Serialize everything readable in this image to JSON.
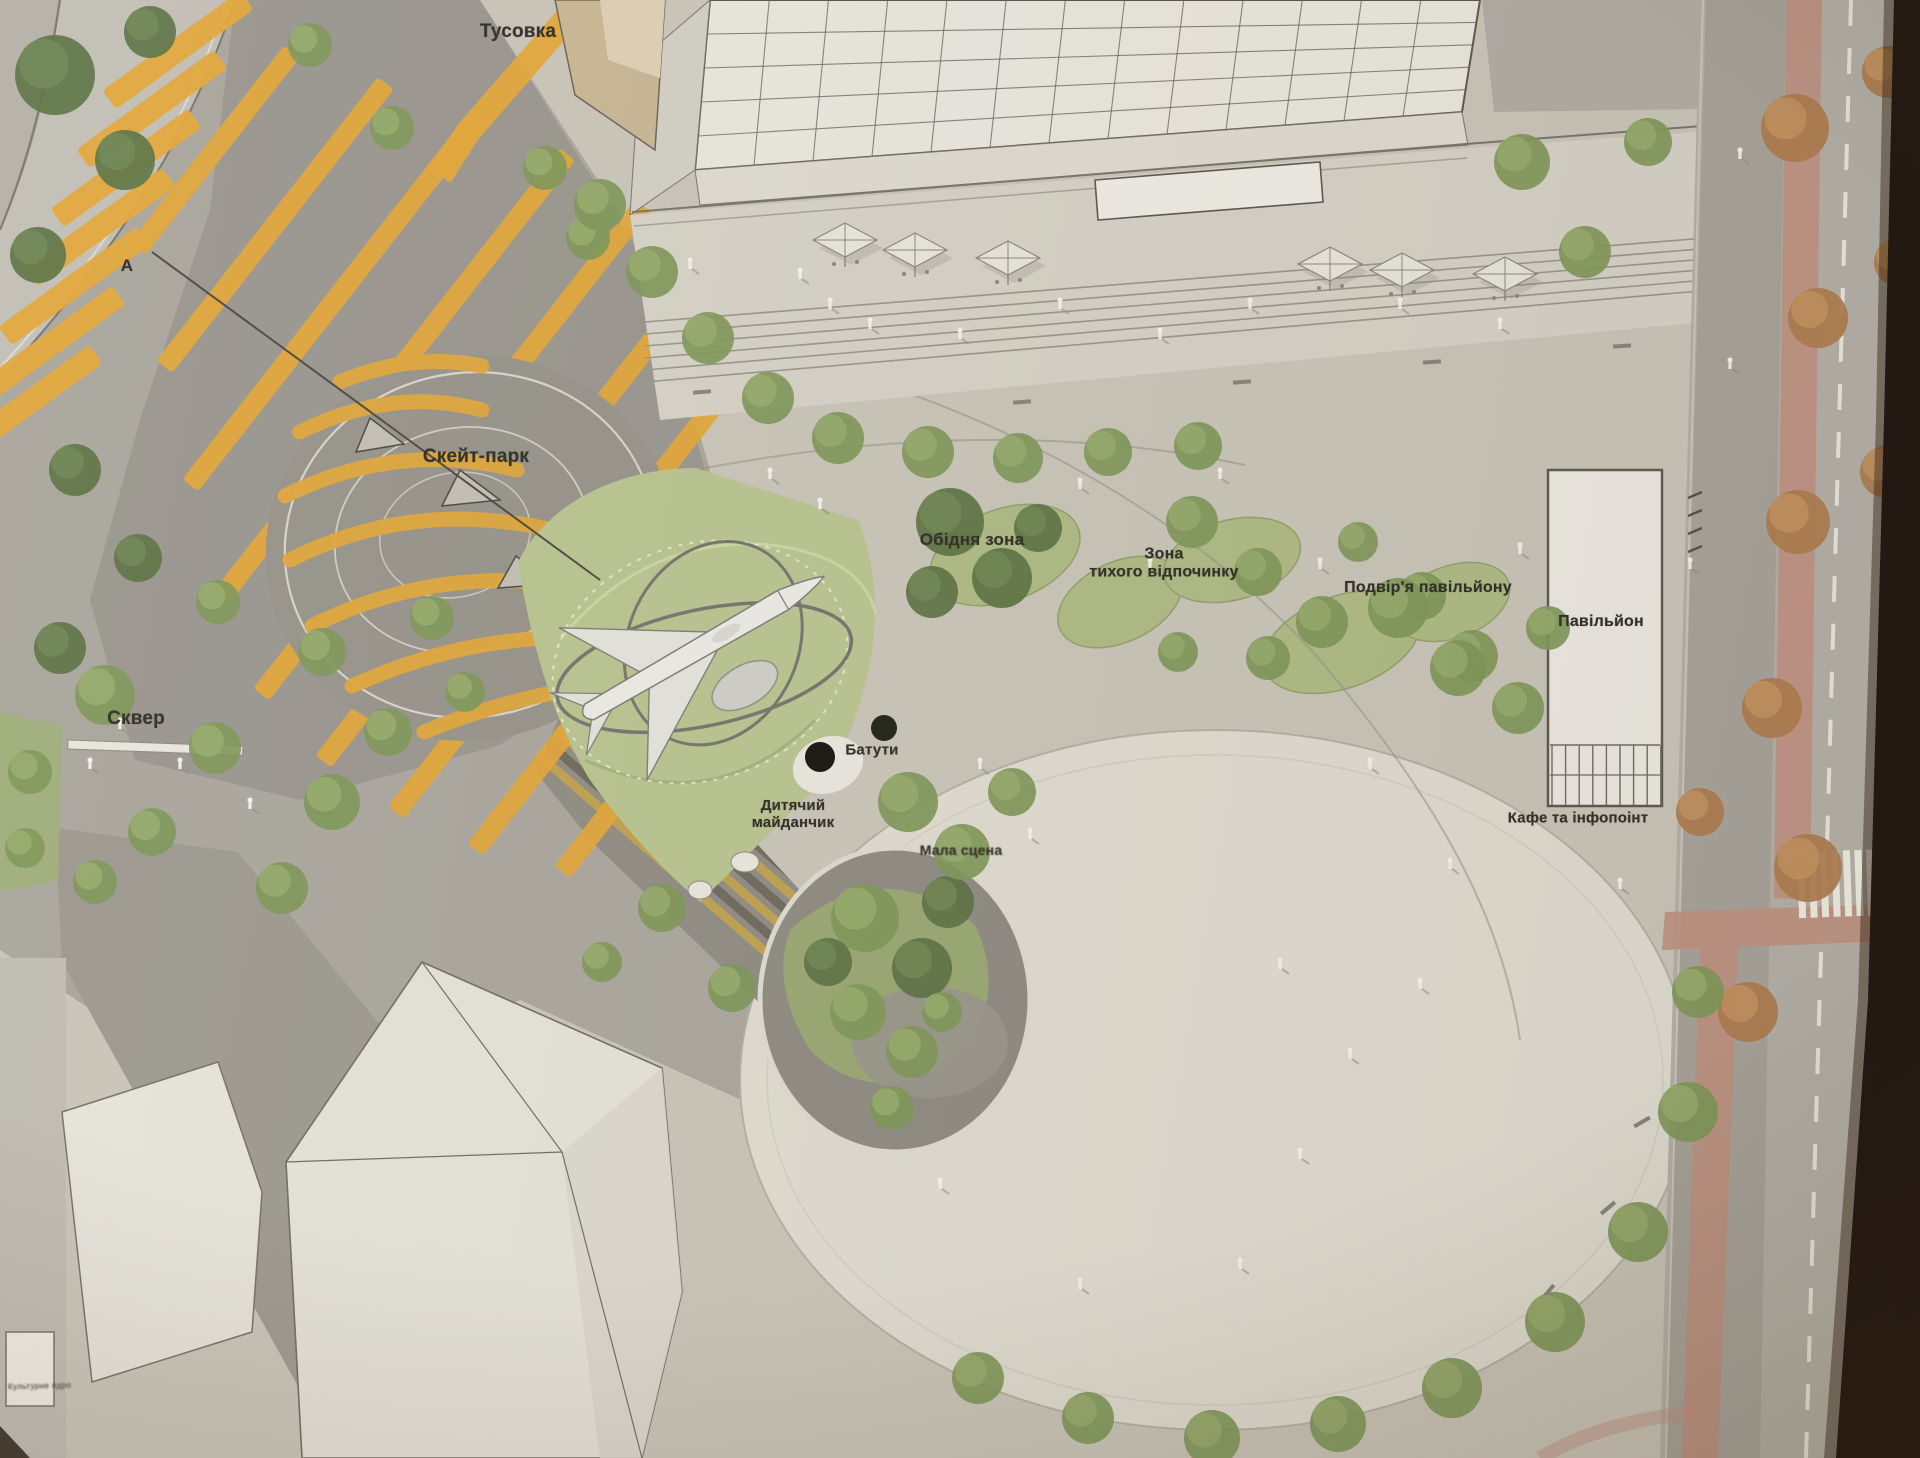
{
  "labels": {
    "tusovka": "Тусовка",
    "skatepark": "Скейт-парк",
    "skver": "Сквер",
    "obidnia_zona": "Обідня зона",
    "zona_tykhoho_l1": "Зона",
    "zona_tykhoho_l2": "тихого відпочинку",
    "podvirya_pavilionu": "Подвір'я павільйону",
    "pavilion": "Павільйон",
    "kafe_infopoint": "Кафе та інфопоінт",
    "batuty": "Батути",
    "dytiachyi_l1": "Дитячий",
    "dytiachyi_l2": "майданчик",
    "mala_stsena": "Мала сцена",
    "section_marker": "А",
    "corner_caption": "Культурне ядро"
  },
  "colors": {
    "paving_base": "#c9c5ba",
    "plaza_circle": "#dfdcd2",
    "road_dark": "#999690",
    "road_light": "#c2bfb7",
    "stripe_yellow": "#e5a634",
    "lawn_green": "#b9c48f",
    "tree_green": "#7d9757",
    "tree_dark": "#5a7242",
    "tree_autumn": "#b07b4c",
    "bike_lane_pink": "#c09181",
    "building_white": "#e9e7e0",
    "photo_edge": "#1f1510"
  }
}
